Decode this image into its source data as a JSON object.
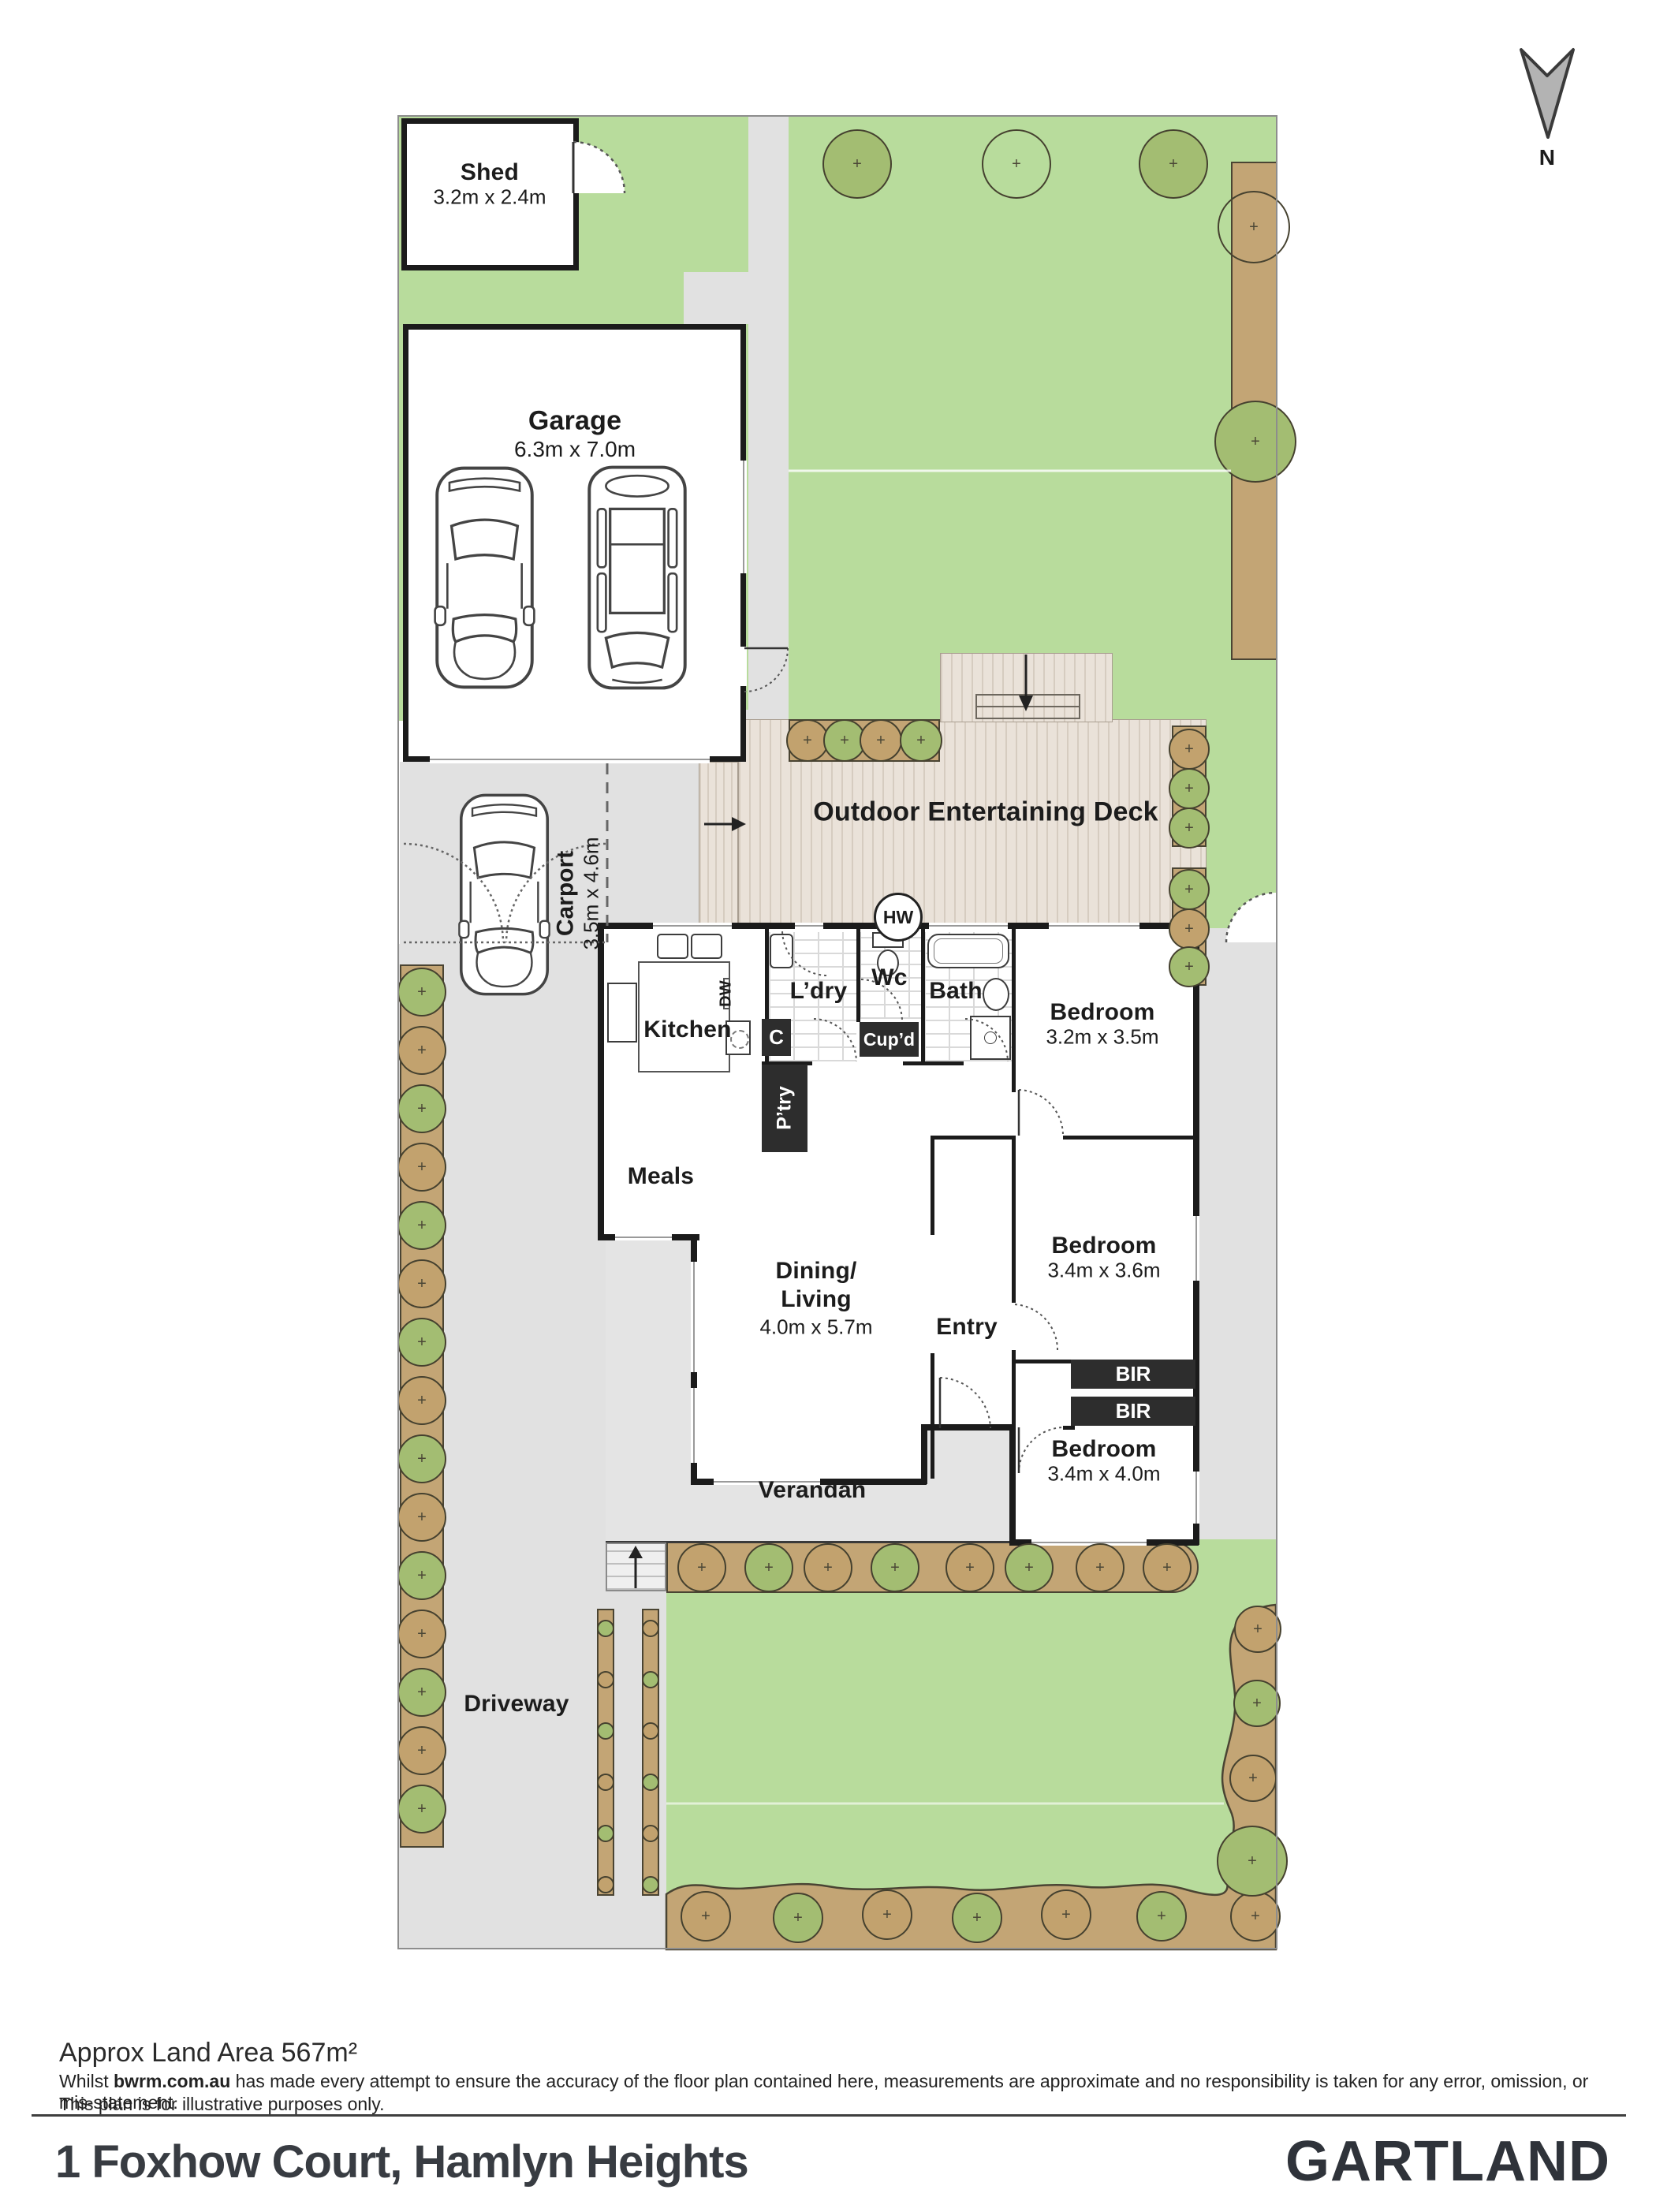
{
  "compass": {
    "label": "N"
  },
  "site": {
    "shed": {
      "name": "Shed",
      "dims": "3.2m x 2.4m"
    },
    "garage": {
      "name": "Garage",
      "dims": "6.3m x 7.0m"
    },
    "carport": {
      "name": "Carport",
      "dims": "3.5m x 4.6m"
    },
    "deck": {
      "name": "Outdoor Entertaining Deck"
    },
    "hot_water": {
      "label": "HW"
    },
    "driveway": {
      "label": "Driveway"
    },
    "verandah": {
      "label": "Verandah"
    }
  },
  "rooms": {
    "kitchen": {
      "label": "Kitchen"
    },
    "dishwasher": {
      "label": "DW"
    },
    "closet": {
      "label": "C"
    },
    "pantry": {
      "label": "P’try"
    },
    "laundry": {
      "label": "L’dry"
    },
    "wc": {
      "label": "Wc"
    },
    "cupboard": {
      "label": "Cup’d"
    },
    "bath": {
      "label": "Bath"
    },
    "meals": {
      "label": "Meals"
    },
    "dining_living": {
      "line1": "Dining/",
      "line2": "Living",
      "dims": "4.0m x 5.7m"
    },
    "entry": {
      "label": "Entry"
    },
    "bedroom1": {
      "label": "Bedroom",
      "dims": "3.2m x 3.5m"
    },
    "bedroom2": {
      "label": "Bedroom",
      "dims": "3.4m x 3.6m"
    },
    "bedroom3": {
      "label": "Bedroom",
      "dims": "3.4m x 4.0m"
    },
    "bir1": {
      "label": "BIR"
    },
    "bir2": {
      "label": "BIR"
    }
  },
  "footer": {
    "land_area": "Approx Land Area 567m²",
    "disclaimer_pre": "Whilst ",
    "disclaimer_bold": "bwrm.com.au",
    "disclaimer_post": " has made every attempt to ensure the accuracy of the floor plan contained here, measurements are approximate and no responsibility is taken for any error, omission, or mis-statement.",
    "disclaimer_line2": "This plan is for illustrative purposes only.",
    "address": "1 Foxhow Court, Hamlyn Heights",
    "brand": "GARTLAND"
  },
  "colors": {
    "lawn": "#b8dc9c",
    "garden": "#c3a575",
    "path": "#e1e1e1",
    "deck": "#eae2d9",
    "wall": "#1b1b1b",
    "unit": "#2d2d2d",
    "brand": "#2f333a"
  }
}
